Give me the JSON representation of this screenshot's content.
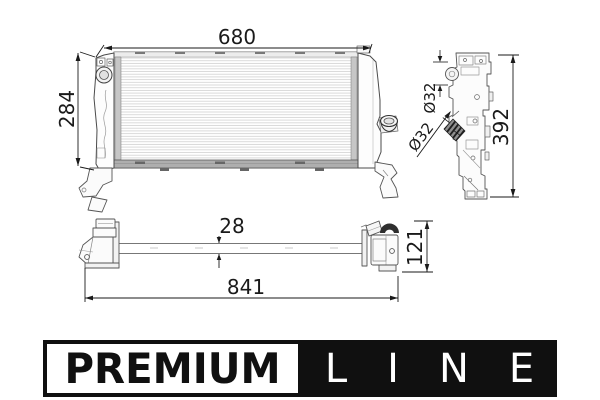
{
  "product_drawing": {
    "kind": "radiator-technical-drawing",
    "front_view": {
      "core_width": "680",
      "core_height": "284"
    },
    "side_view": {
      "overall_height": "392",
      "top_port_diameter": "Ø32",
      "side_port_diameter": "Ø32"
    },
    "bottom_view": {
      "core_depth": "28",
      "overall_length": "841",
      "end_tank_height": "121"
    }
  },
  "logo": {
    "premium_label": "PREMIUM",
    "line_label": "LINE"
  },
  "colors": {
    "line_art": "#4a4a4a",
    "dimension": "#1a1a1a",
    "fins": "#d6d6d6",
    "logo_black": "#101010",
    "logo_white": "#ffffff"
  }
}
